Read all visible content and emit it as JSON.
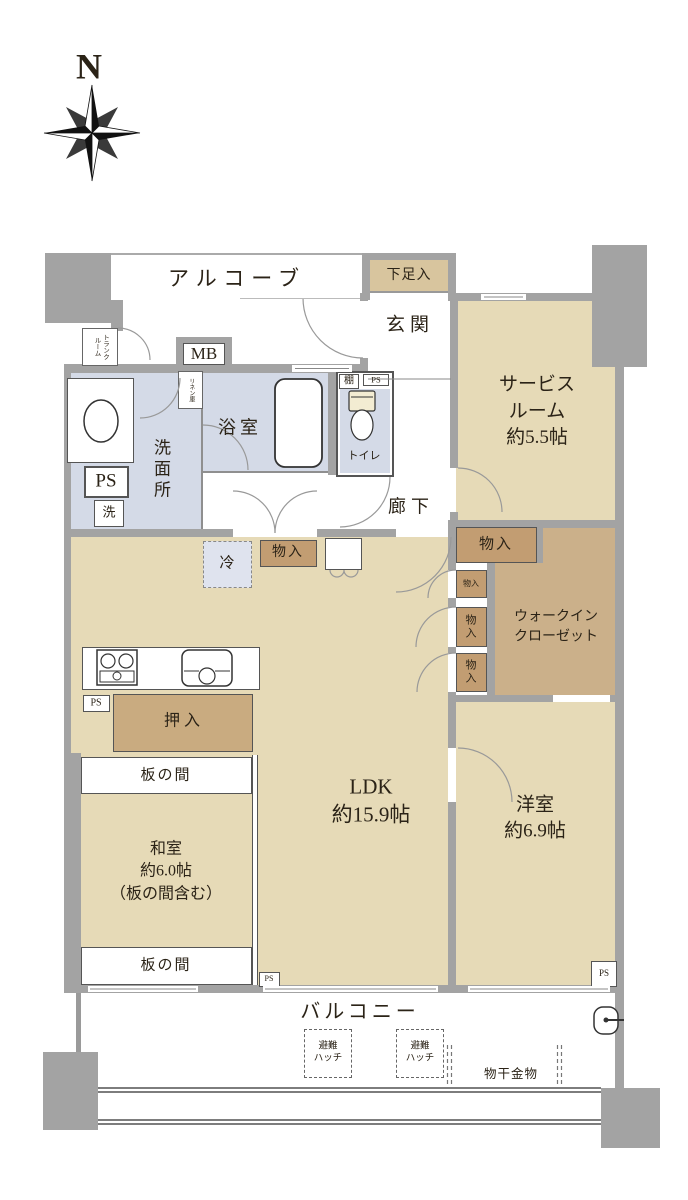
{
  "title": "マンション間取り図",
  "colors": {
    "wall": "#a3a3a3",
    "room": "#e6dab7",
    "room_dark": "#cbb08a",
    "storage_dark": "#c29d72",
    "closet_dark": "#c9ab80",
    "wet_area": "#d4dae7",
    "shoe_tan": "#d8c59e",
    "tank_cream": "#f3ecd2"
  },
  "compass": {
    "north_label": "N"
  },
  "rooms": {
    "alcove": "アルコーブ",
    "shoe_storage": "下足入",
    "entrance": "玄関",
    "service_room": [
      "サービス",
      "ルーム",
      "約5.5帖"
    ],
    "trunk_room": [
      "トランク",
      "ルーム"
    ],
    "meter_box": "MB",
    "linen_cabinet": "リネン庫",
    "washroom": "洗面所",
    "bathroom": "浴室",
    "shelf": "棚",
    "pipe_space": "PS",
    "laundry": "洗",
    "toilet": "トイレ",
    "corridor": "廊下",
    "refrigerator": "冷",
    "storage": "物入",
    "storage_stacked": [
      "物",
      "入"
    ],
    "walk_in_closet": [
      "ウォークイン",
      "クローゼット"
    ],
    "closet": "押入",
    "wood_floor": "板の間",
    "japanese_room": [
      "和室",
      "約6.0帖",
      "（板の間含む）"
    ],
    "ldk": [
      "LDK",
      "約15.9帖"
    ],
    "western_room": [
      "洋室",
      "約6.9帖"
    ],
    "balcony": "バルコニー",
    "escape_hatch": [
      "避難",
      "ハッチ"
    ],
    "laundry_pole": "物干金物"
  }
}
